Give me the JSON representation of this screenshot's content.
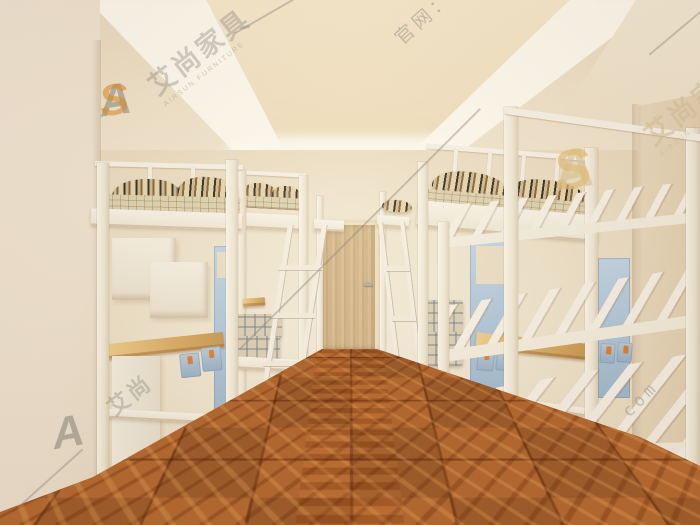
{
  "image": {
    "kind": "3d-interior-render",
    "subject": "student dormitory room with white metal loft beds, desks, lockers and shelf rack"
  },
  "watermark": {
    "logo_a": "A",
    "logo_s": "S",
    "brand_cn": "艾尚家具",
    "brand_cn_short": "艾尚",
    "brand_en": "AIRSUN FURNITURE",
    "site_label": "官网：www.as505.com",
    "site_short": "www.as505.com",
    "site_fragment": "as505. com"
  },
  "colors": {
    "wall_cream": "#efe3d0",
    "ceiling_glow": "#fffcf2",
    "floor_parquet": "#b0662f",
    "desk_wood": "#d8a65c",
    "door_wood": "#cfae7f",
    "locker_blue": "#a9c3dc",
    "handle_orange": "#e2751f",
    "frame_white": "#f6f0e4",
    "watermark_gray": "#8f8a80",
    "watermark_orange": "#d48c2c",
    "watermark_beige": "#d6c294"
  }
}
